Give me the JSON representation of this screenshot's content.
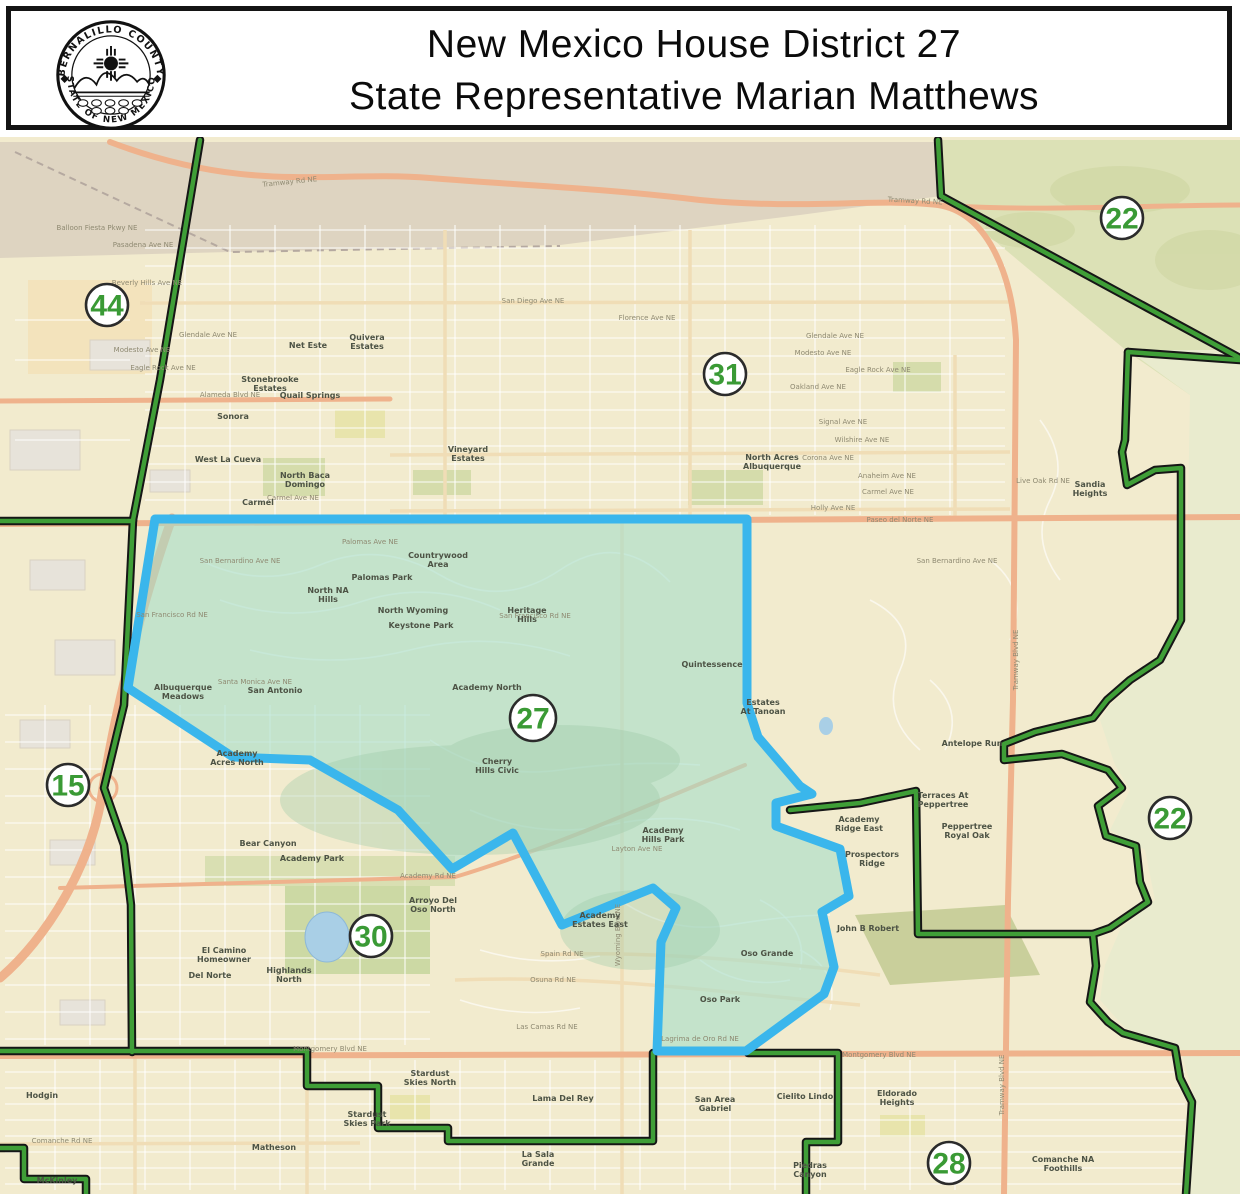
{
  "header": {
    "title_line1": "New Mexico House District 27",
    "title_line2": "State Representative Marian Matthews",
    "seal_top": "BERNALILLO COUNTY",
    "seal_bottom": "STATE OF NEW MEXICO"
  },
  "map": {
    "colors": {
      "base": "#f2ebce",
      "mesa": "#ded4c1",
      "mountain": "#dce1b6",
      "foothill": "#e9ebce",
      "water": "#a9cfe6",
      "major_road": "#efb28c",
      "boundary_green": "#3f9e37",
      "boundary_casing": "#161616",
      "district_fill": "#a5ddc9",
      "district_border": "#3ab6ec",
      "district_number_green": "#3a9a35"
    },
    "district_labels": [
      {
        "number": "44",
        "x": 107,
        "y": 305
      },
      {
        "number": "22",
        "x": 1122,
        "y": 218
      },
      {
        "number": "31",
        "x": 725,
        "y": 374
      },
      {
        "number": "15",
        "x": 68,
        "y": 785
      },
      {
        "number": "27",
        "x": 533,
        "y": 718
      },
      {
        "number": "30",
        "x": 371,
        "y": 936
      },
      {
        "number": "22",
        "x": 1170,
        "y": 818
      },
      {
        "number": "28",
        "x": 949,
        "y": 1163
      }
    ],
    "street_labels": [
      {
        "name": "Tramway Rd NE",
        "x": 290,
        "y": 184,
        "rot": -6
      },
      {
        "name": "Tramway Rd NE",
        "x": 915,
        "y": 203,
        "rot": 3
      },
      {
        "name": "Balloon Fiesta Pkwy NE",
        "x": 97,
        "y": 230,
        "rot": 0
      },
      {
        "name": "Pasadena Ave NE",
        "x": 143,
        "y": 247,
        "rot": 0
      },
      {
        "name": "Beverly Hills Ave NE",
        "x": 147,
        "y": 285,
        "rot": 0
      },
      {
        "name": "San Diego Ave NE",
        "x": 533,
        "y": 303,
        "rot": 0
      },
      {
        "name": "Glendale Ave NE",
        "x": 208,
        "y": 337,
        "rot": 0
      },
      {
        "name": "Glendale Ave NE",
        "x": 835,
        "y": 338,
        "rot": 0
      },
      {
        "name": "Florence Ave NE",
        "x": 647,
        "y": 320,
        "rot": 0
      },
      {
        "name": "Modesto Ave NE",
        "x": 142,
        "y": 352,
        "rot": 0
      },
      {
        "name": "Modesto Ave NE",
        "x": 823,
        "y": 355,
        "rot": 0
      },
      {
        "name": "Eagle Rock Ave NE",
        "x": 163,
        "y": 370,
        "rot": 0
      },
      {
        "name": "Eagle Rock Ave NE",
        "x": 878,
        "y": 372,
        "rot": 0
      },
      {
        "name": "Oakland Ave NE",
        "x": 818,
        "y": 389,
        "rot": 0
      },
      {
        "name": "Alameda Blvd NE",
        "x": 230,
        "y": 397,
        "rot": 0
      },
      {
        "name": "Signal Ave NE",
        "x": 843,
        "y": 424,
        "rot": 0
      },
      {
        "name": "Wilshire Ave NE",
        "x": 862,
        "y": 442,
        "rot": 0
      },
      {
        "name": "Corona Ave NE",
        "x": 828,
        "y": 460,
        "rot": 0
      },
      {
        "name": "Anaheim Ave NE",
        "x": 887,
        "y": 478,
        "rot": 0
      },
      {
        "name": "Carmel Ave NE",
        "x": 888,
        "y": 494,
        "rot": 0
      },
      {
        "name": "Carmel Ave NE",
        "x": 293,
        "y": 500,
        "rot": 0
      },
      {
        "name": "Holly Ave NE",
        "x": 833,
        "y": 510,
        "rot": 0
      },
      {
        "name": "Paseo del Norte NE",
        "x": 900,
        "y": 522,
        "rot": 0
      },
      {
        "name": "Palomas Ave NE",
        "x": 370,
        "y": 544,
        "rot": 0
      },
      {
        "name": "San Bernardino Ave NE",
        "x": 240,
        "y": 563,
        "rot": 0
      },
      {
        "name": "San Bernardino Ave NE",
        "x": 957,
        "y": 563,
        "rot": 0
      },
      {
        "name": "San Francisco Rd NE",
        "x": 172,
        "y": 617,
        "rot": 0
      },
      {
        "name": "San Francisco Rd NE",
        "x": 535,
        "y": 618,
        "rot": 0
      },
      {
        "name": "Santa Monica Ave NE",
        "x": 255,
        "y": 684,
        "rot": 0
      },
      {
        "name": "Academy Rd NE",
        "x": 428,
        "y": 878,
        "rot": 0
      },
      {
        "name": "Layton Ave NE",
        "x": 637,
        "y": 851,
        "rot": 0
      },
      {
        "name": "Spain Rd NE",
        "x": 562,
        "y": 956,
        "rot": 0
      },
      {
        "name": "Osuna Rd NE",
        "x": 553,
        "y": 982,
        "rot": 0
      },
      {
        "name": "Las Camas Rd NE",
        "x": 547,
        "y": 1029,
        "rot": 0
      },
      {
        "name": "Lagrima de Oro Rd NE",
        "x": 700,
        "y": 1041,
        "rot": 0
      },
      {
        "name": "Montgomery Blvd NE",
        "x": 330,
        "y": 1051,
        "rot": 0
      },
      {
        "name": "Montgomery Blvd NE",
        "x": 879,
        "y": 1057,
        "rot": 0
      },
      {
        "name": "Comanche Rd NE",
        "x": 62,
        "y": 1143,
        "rot": 0
      },
      {
        "name": "Live Oak Rd NE",
        "x": 1043,
        "y": 483,
        "rot": 0
      },
      {
        "name": "Tramway Blvd NE",
        "x": 1018,
        "y": 660,
        "rot": -90
      },
      {
        "name": "Tramway Blvd NE",
        "x": 1004,
        "y": 1085,
        "rot": -90
      },
      {
        "name": "Wyoming Blvd NE",
        "x": 620,
        "y": 935,
        "rot": -90
      }
    ],
    "neighborhood_labels": [
      {
        "name": "Stonebrooke Estates",
        "x": 270,
        "y": 382
      },
      {
        "name": "Quail Springs",
        "x": 310,
        "y": 398
      },
      {
        "name": "Sonora",
        "x": 233,
        "y": 419
      },
      {
        "name": "West La Cueva",
        "x": 228,
        "y": 462
      },
      {
        "name": "North Domingo Baca",
        "x": 305,
        "y": 478
      },
      {
        "name": "Carmel",
        "x": 258,
        "y": 505
      },
      {
        "name": "Net Este",
        "x": 308,
        "y": 348
      },
      {
        "name": "Quivera Estates",
        "x": 367,
        "y": 340
      },
      {
        "name": "North Albuquerque Acres",
        "x": 772,
        "y": 460
      },
      {
        "name": "Vineyard Estates",
        "x": 468,
        "y": 452
      },
      {
        "name": "Sandia Heights",
        "x": 1090,
        "y": 487
      },
      {
        "name": "North Hills NA",
        "x": 328,
        "y": 593
      },
      {
        "name": "Palomas Park",
        "x": 382,
        "y": 580
      },
      {
        "name": "Countrywood Area",
        "x": 438,
        "y": 558
      },
      {
        "name": "North Wyoming",
        "x": 413,
        "y": 613
      },
      {
        "name": "Keystone Park",
        "x": 421,
        "y": 628
      },
      {
        "name": "Heritage Hills",
        "x": 527,
        "y": 613
      },
      {
        "name": "Albuquerque Meadows",
        "x": 183,
        "y": 690
      },
      {
        "name": "San Antonio",
        "x": 275,
        "y": 693
      },
      {
        "name": "Academy North",
        "x": 487,
        "y": 690
      },
      {
        "name": "Cherry Hills Civic",
        "x": 497,
        "y": 764
      },
      {
        "name": "Quintessence",
        "x": 712,
        "y": 667
      },
      {
        "name": "Estates At Tanoan",
        "x": 763,
        "y": 705
      },
      {
        "name": "Antelope Run",
        "x": 972,
        "y": 746
      },
      {
        "name": "Terraces At Peppertree",
        "x": 943,
        "y": 798
      },
      {
        "name": "Peppertree Royal Oak",
        "x": 967,
        "y": 829
      },
      {
        "name": "Academy Ridge East",
        "x": 859,
        "y": 822
      },
      {
        "name": "Prospectors Ridge",
        "x": 872,
        "y": 857
      },
      {
        "name": "John B Robert",
        "x": 868,
        "y": 931
      },
      {
        "name": "Oso Grande",
        "x": 767,
        "y": 956
      },
      {
        "name": "Oso Park",
        "x": 720,
        "y": 1002
      },
      {
        "name": "Academy Estates East",
        "x": 600,
        "y": 918
      },
      {
        "name": "Academy Hills Park",
        "x": 663,
        "y": 833
      },
      {
        "name": "Academy Acres North",
        "x": 237,
        "y": 756
      },
      {
        "name": "Bear Canyon",
        "x": 268,
        "y": 846
      },
      {
        "name": "Academy Park",
        "x": 312,
        "y": 861
      },
      {
        "name": "Arroyo Del Oso North",
        "x": 433,
        "y": 903
      },
      {
        "name": "Highlands North",
        "x": 289,
        "y": 973
      },
      {
        "name": "El Camino Homeowner",
        "x": 224,
        "y": 953
      },
      {
        "name": "Del Norte",
        "x": 210,
        "y": 978
      },
      {
        "name": "Hodgin",
        "x": 42,
        "y": 1098
      },
      {
        "name": "McKinley",
        "x": 57,
        "y": 1183
      },
      {
        "name": "Matheson",
        "x": 274,
        "y": 1150
      },
      {
        "name": "Stardust Skies North",
        "x": 430,
        "y": 1076
      },
      {
        "name": "Stardust Skies Park",
        "x": 367,
        "y": 1117
      },
      {
        "name": "Lama Del Rey",
        "x": 563,
        "y": 1101
      },
      {
        "name": "San Gabriel Area",
        "x": 715,
        "y": 1102
      },
      {
        "name": "La Sala Grande",
        "x": 538,
        "y": 1157
      },
      {
        "name": "Cielito Lindo",
        "x": 805,
        "y": 1099
      },
      {
        "name": "Eldorado Heights",
        "x": 897,
        "y": 1096
      },
      {
        "name": "Comanche Foothills NA",
        "x": 1063,
        "y": 1162
      },
      {
        "name": "Piedras Canyon",
        "x": 810,
        "y": 1168
      }
    ]
  }
}
